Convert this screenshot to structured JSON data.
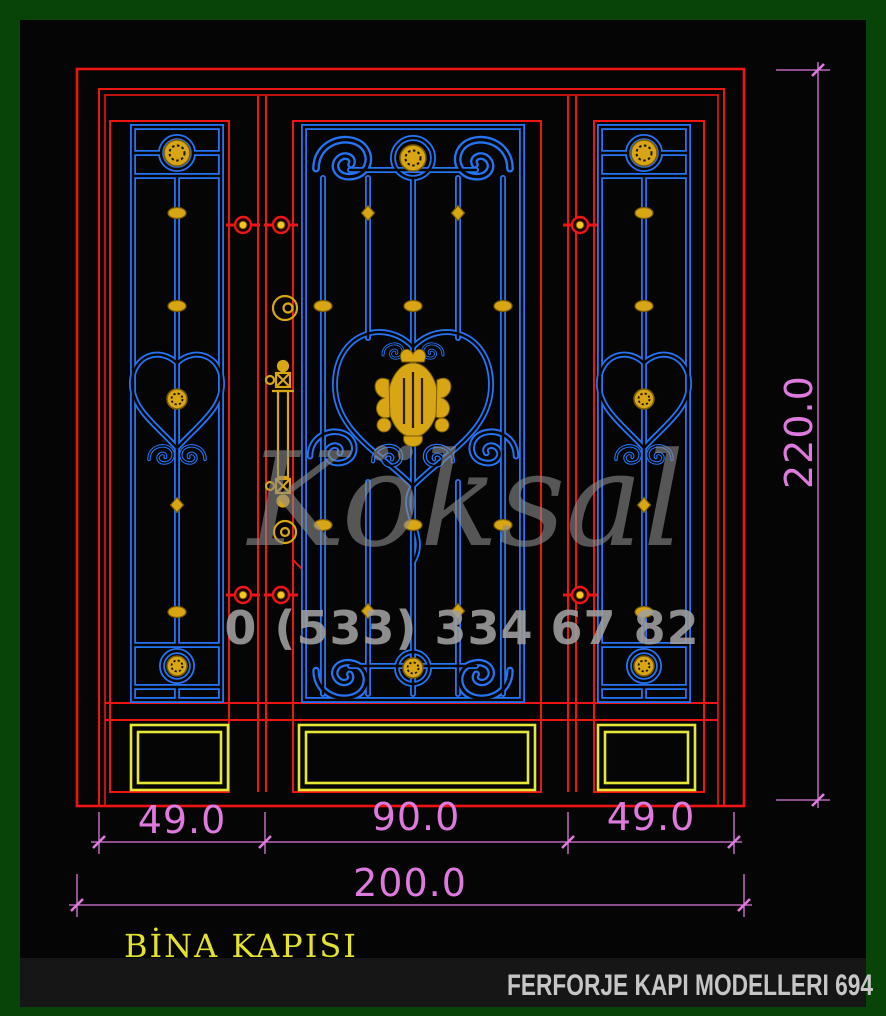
{
  "drawing": {
    "title": "BİNA KAPISI",
    "footer": "FERFORJE KAPI MODELLERI 694",
    "watermark_brand": "Köksal",
    "watermark_phone": "0 (533) 334 67 82",
    "dimensions": {
      "left_panel_width": "49.0",
      "center_panel_width": "90.0",
      "right_panel_width": "49.0",
      "total_width": "200.0",
      "total_height": "220.0"
    },
    "colors": {
      "border_green": "#084308",
      "background_black": "#050505",
      "frame_red": "#ee1515",
      "iron_blue": "#2574f4",
      "ornament_gold": "#d8a614",
      "kick_plate_yellow": "#e6e636",
      "dimension_magenta": "#de7ade",
      "watermark_gray": "#8d8d8d",
      "footer_strip": "#161616"
    }
  }
}
